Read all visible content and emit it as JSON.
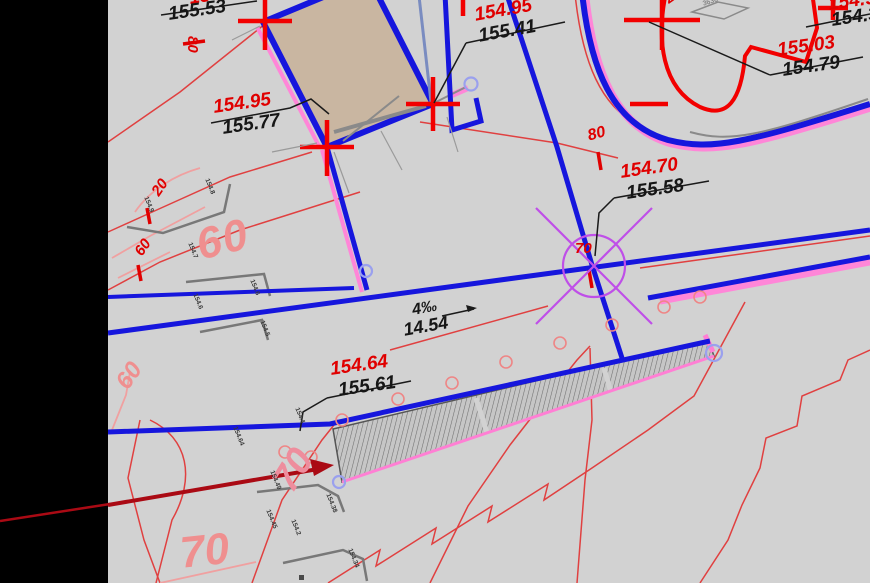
{
  "app": {
    "type": "cad-site-plan-fragment"
  },
  "building": {
    "label": "ТП"
  },
  "axis_bubbles": {
    "n1": "1",
    "n2": "2",
    "a": "А",
    "b": "Б",
    "v": "В"
  },
  "elevations": {
    "top_left": {
      "design": "154.4",
      "existing": "155.53"
    },
    "axis1": {
      "design": "154.95",
      "existing": "155.77"
    },
    "canopy": {
      "design": "154.95",
      "existing": "155.41"
    },
    "north_east": {
      "design": "155.03",
      "existing": "154.79"
    },
    "corner_ne": {
      "design": "154.9",
      "existing": "154.3"
    },
    "road_point": {
      "design": "154.70",
      "existing": "155.58"
    },
    "wall_point": {
      "design": "154.64",
      "existing": "155.61"
    }
  },
  "slope": {
    "grade": "4‰",
    "length": "14.54"
  },
  "contour_labels": {
    "left_80": "80",
    "mid_80": "80",
    "small_20": "20",
    "small_60": "60",
    "big_60": "60",
    "left_60": "60",
    "point_70": "70",
    "pink_70": "70",
    "big_70": "70"
  },
  "notes": {
    "corner_note": "2.0",
    "block_note": "3636"
  },
  "micro_labels": [
    "154.8",
    "154.9",
    "154.7",
    "154.6",
    "154.6",
    "154.5",
    "154.64",
    "154.49",
    "154.45",
    "154.2",
    "154.38",
    "154.34",
    "154.4"
  ]
}
